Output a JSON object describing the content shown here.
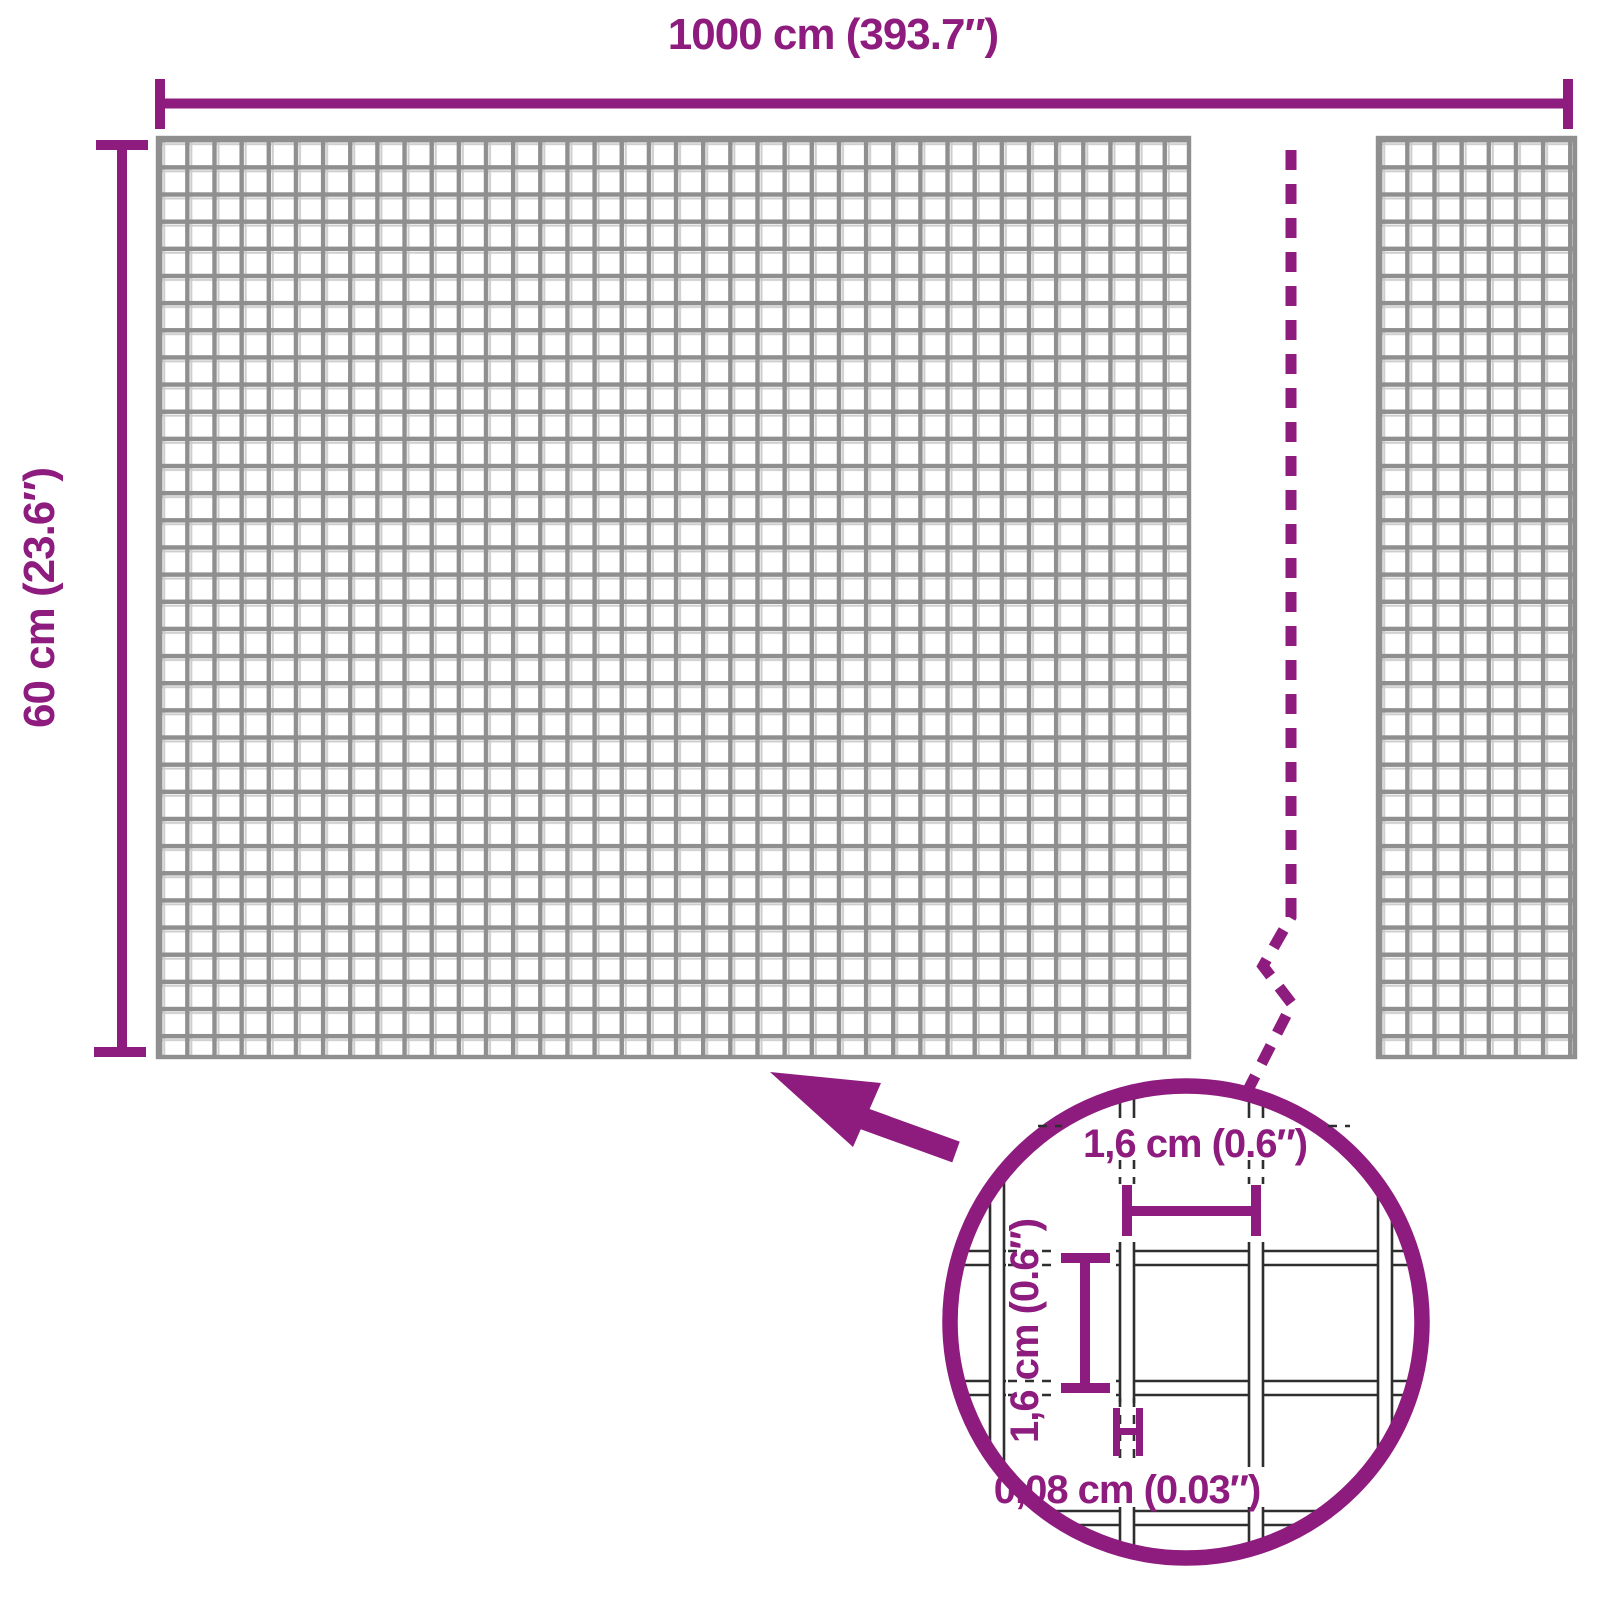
{
  "page": {
    "description": "Product dimension diagram of a roll of welded wire mesh with a magnified detail circle"
  },
  "dimensions": {
    "width_label": "1000 cm (393.7″)",
    "height_label": "60 cm (23.6″)"
  },
  "detail": {
    "mesh_opening_width": "1,6 cm (0.6″)",
    "mesh_opening_height": "1,6 cm (0.6″)",
    "wire_thickness": "0,08 cm (0.03″)"
  },
  "icons": [
    {
      "name": "magnifier-arrow",
      "meaning": "callout arrow pointing from the detail circle to the mesh"
    },
    {
      "name": "break-line",
      "meaning": "dashed zigzag break line indicating omitted mesh length"
    }
  ],
  "colors": {
    "accent_purple": "#8E1B7E",
    "mesh_gray": "#8F8F8F",
    "mesh_gray_light": "#CDCDCD",
    "detail_wire_dark": "#2E2E2E",
    "background": "#FFFFFF"
  }
}
